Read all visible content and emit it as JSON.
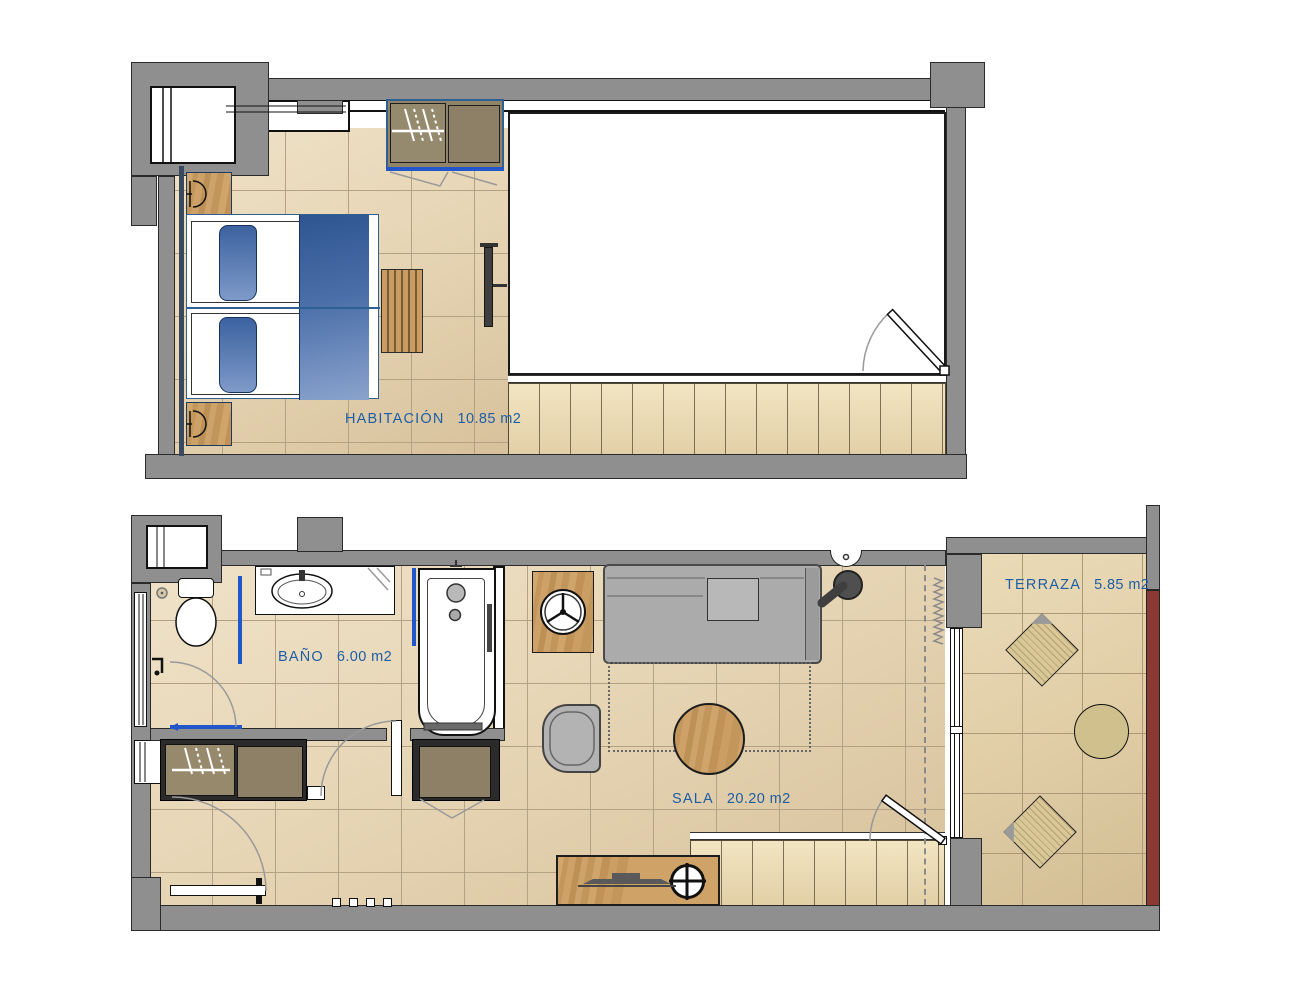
{
  "rooms": {
    "habitacion": {
      "label": "HABITACIÓN",
      "area": "10.85 m2"
    },
    "bano": {
      "label": "BAÑO",
      "area": "6.00 m2"
    },
    "sala": {
      "label": "SALA",
      "area": "20.20 m2"
    },
    "terraza": {
      "label": "TERRAZA",
      "area": "5.85 m2"
    }
  },
  "colors": {
    "label_text": "#1d5ea6",
    "wall_gray": "#8f8f8f",
    "floor_tile": "#e7d6b6",
    "terrace_tile": "#e1cea7",
    "wood": "#c89c62",
    "closet_door": "#97896b",
    "bed_blue": "#3c62a0",
    "accent_blue": "#2257c9",
    "maroon_strip": "#8a3a33",
    "sofa_gray": "#ababab",
    "empty_room": "#ffffff"
  }
}
